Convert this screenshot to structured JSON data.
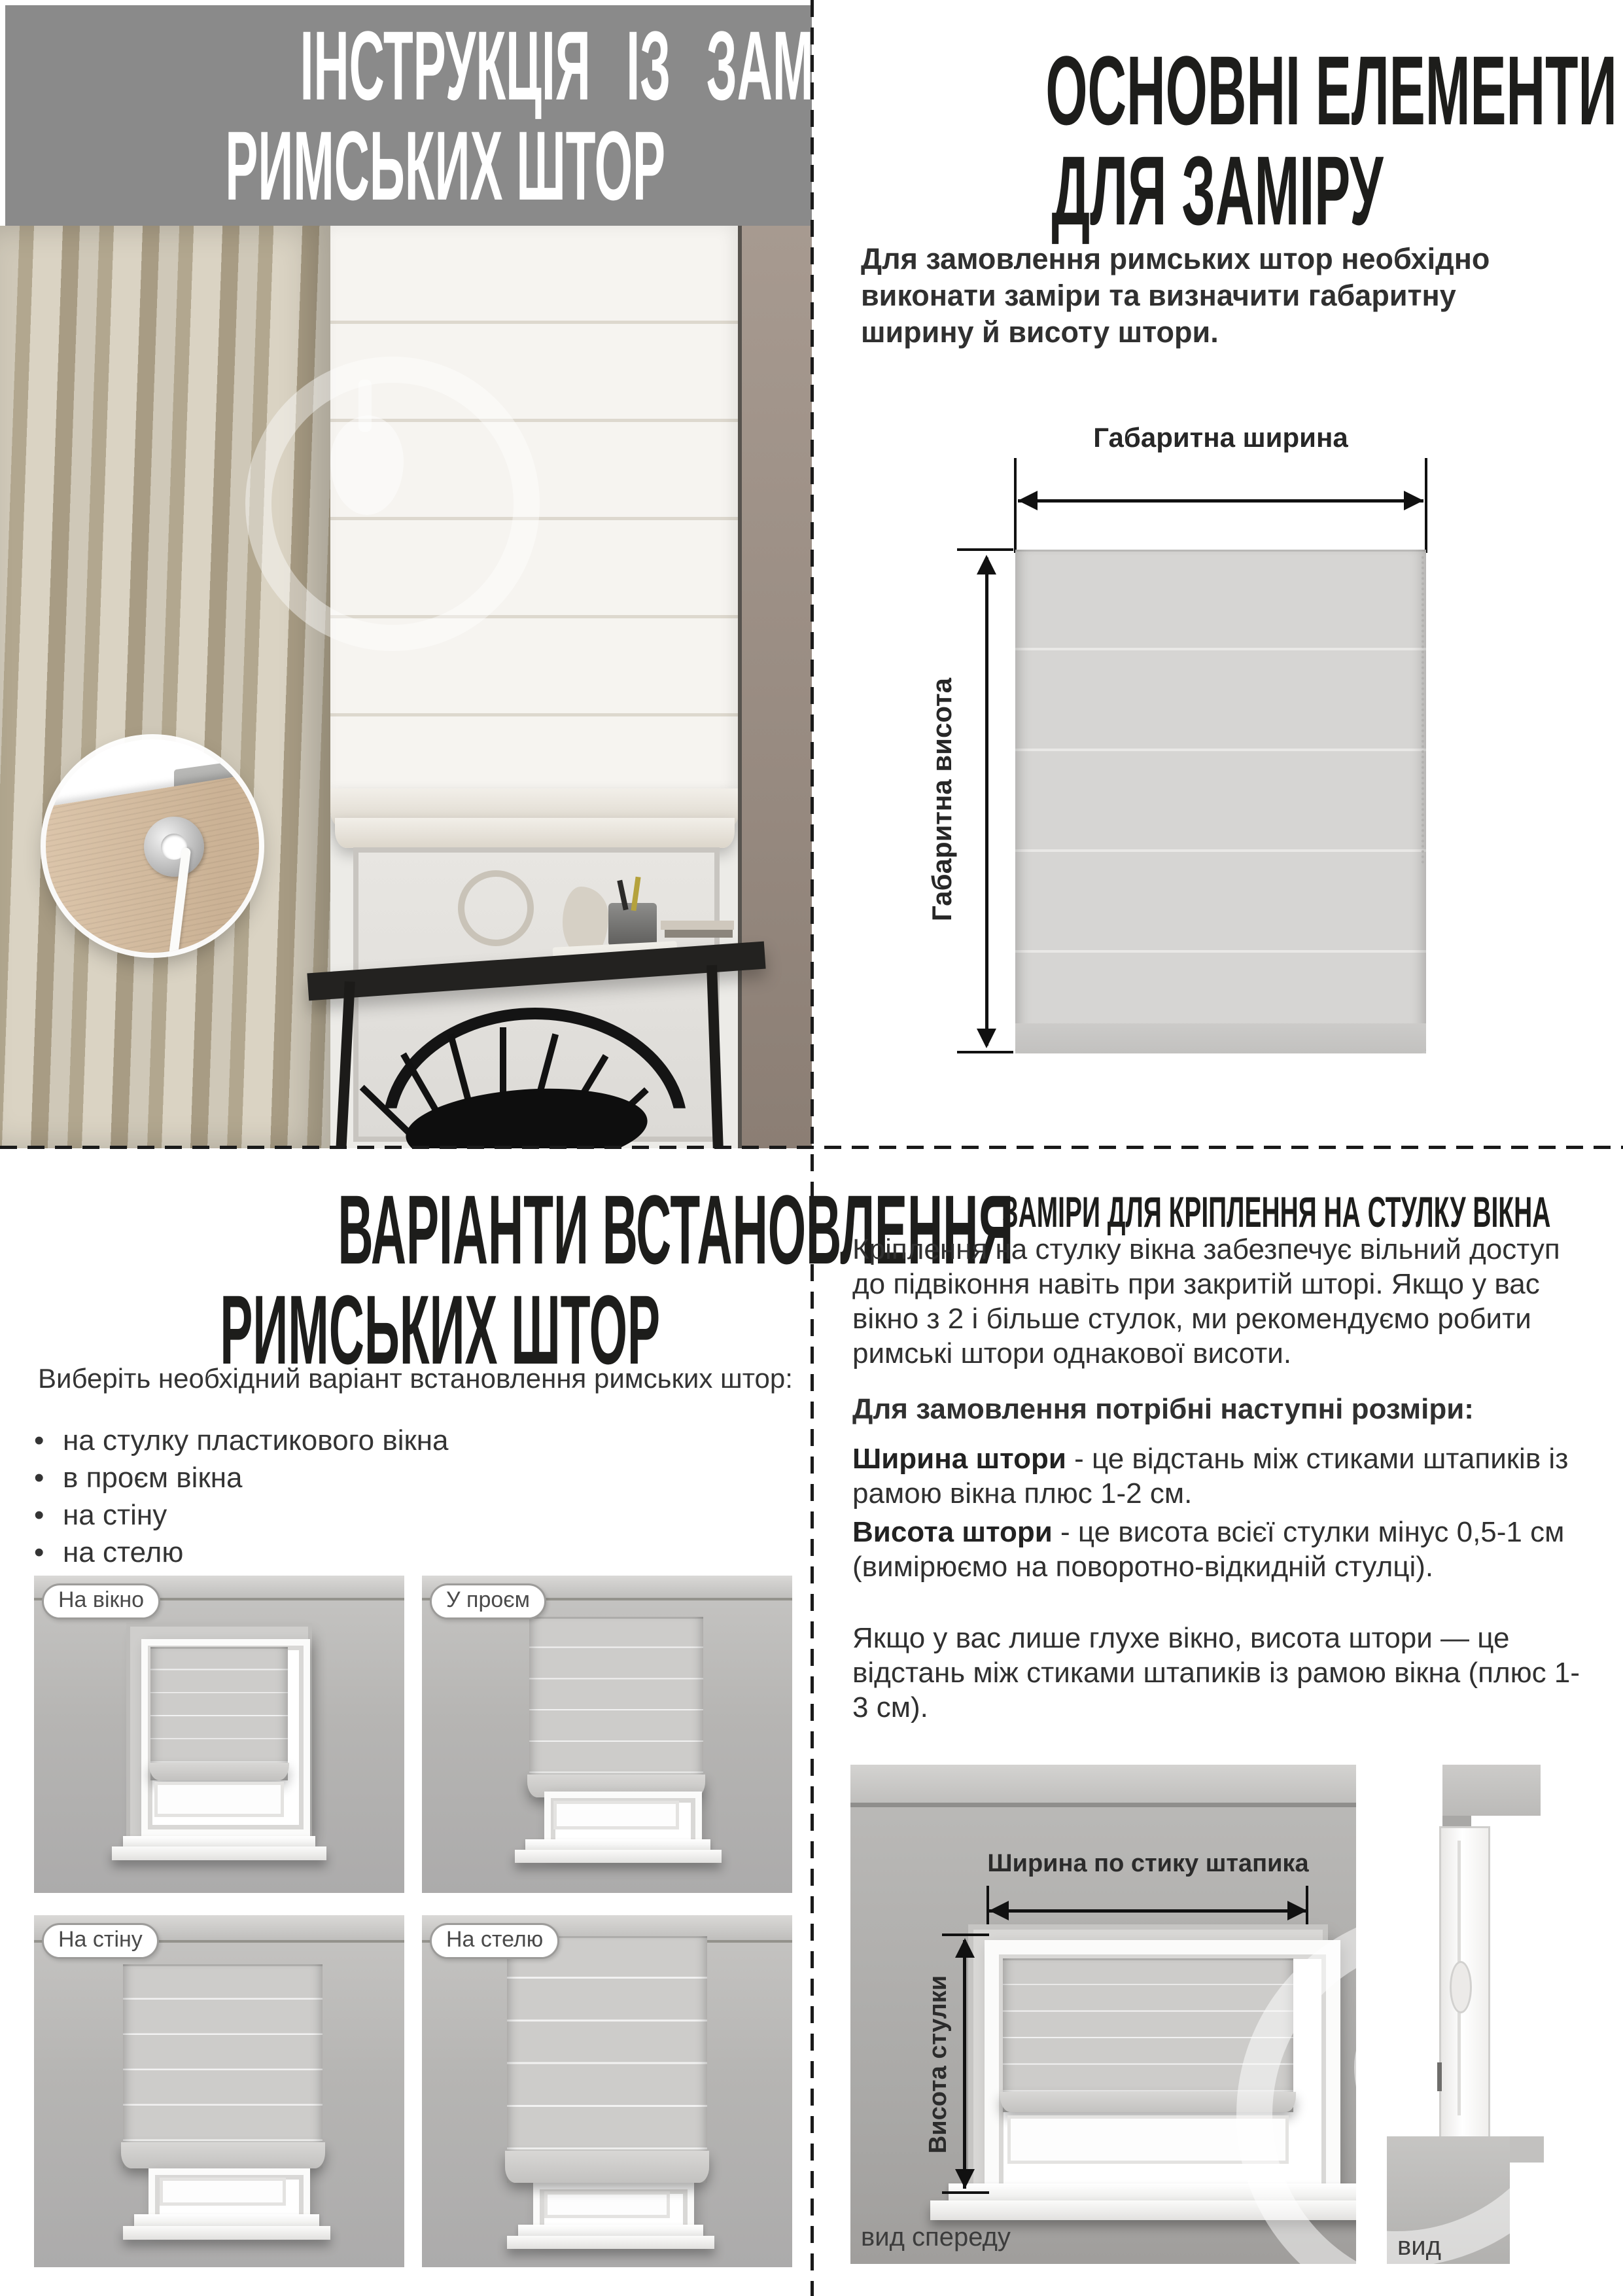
{
  "title": {
    "line1": "ІНСТРУКЦІЯ ІЗ ЗАМІРУ",
    "line2": "РИМСЬКИХ ШТОР"
  },
  "elements": {
    "heading1": "ОСНОВНІ ЕЛЕМЕНТИ",
    "heading2": "ДЛЯ ЗАМІРУ",
    "intro": "Для замовлення римських штор необхідно виконати заміри та визначити габаритну ширину й висоту штори.",
    "width_label": "Габаритна ширина",
    "height_label": "Габаритна висота"
  },
  "install": {
    "heading1": "ВАРІАНТИ ВСТАНОВЛЕННЯ",
    "heading2": "РИМСЬКИХ ШТОР",
    "intro": "Виберіть необхідний варіант встановлення римських штор:",
    "bullets": [
      "на стулку пластикового вікна",
      "в проєм вікна",
      "на стіну",
      "на стелю"
    ],
    "variants": [
      {
        "label": "На вікно"
      },
      {
        "label": "У проєм"
      },
      {
        "label": "На стіну"
      },
      {
        "label": "На стелю"
      }
    ]
  },
  "sash": {
    "heading": "ЗАМІРИ ДЛЯ КРІПЛЕННЯ НА СТУЛКУ ВІКНА",
    "p1": "Кріплення на стулку вікна забезпечує вільний доступ до підвіконня навіть при закритій шторі. Якщо у вас вікно з 2 і більше стулок, ми рекомендуємо робити римські штори однакової висоти.",
    "lead": "Для замовлення потрібні наступні розміри:",
    "width_term": "Ширина штори",
    "width_def": " - це відстань між стиками штапиків із рамою вікна плюс 1-2 см.",
    "height_term": "Висота штори",
    "height_def": " - це висота всієї стулки мінус 0,5-1 см (вимірюємо на поворотно-відкидній стулці).",
    "p2": "Якщо у вас лише глухе вікно, висота штори — це відстань між стиками штапиків із рамою вікна (плюс 1-3 см).",
    "width_label": "Ширина по стику штапика",
    "height_label": "Висота стулки",
    "front_caption": "вид спереду",
    "side_caption": "вид збоку"
  },
  "colors": {
    "header_gray": "#8a8a8a",
    "heading_text": "#1d1d1b",
    "body_text": "#303030",
    "diagram_blind": "#d6d5d3",
    "scene_wall": "#b6b5b3"
  }
}
